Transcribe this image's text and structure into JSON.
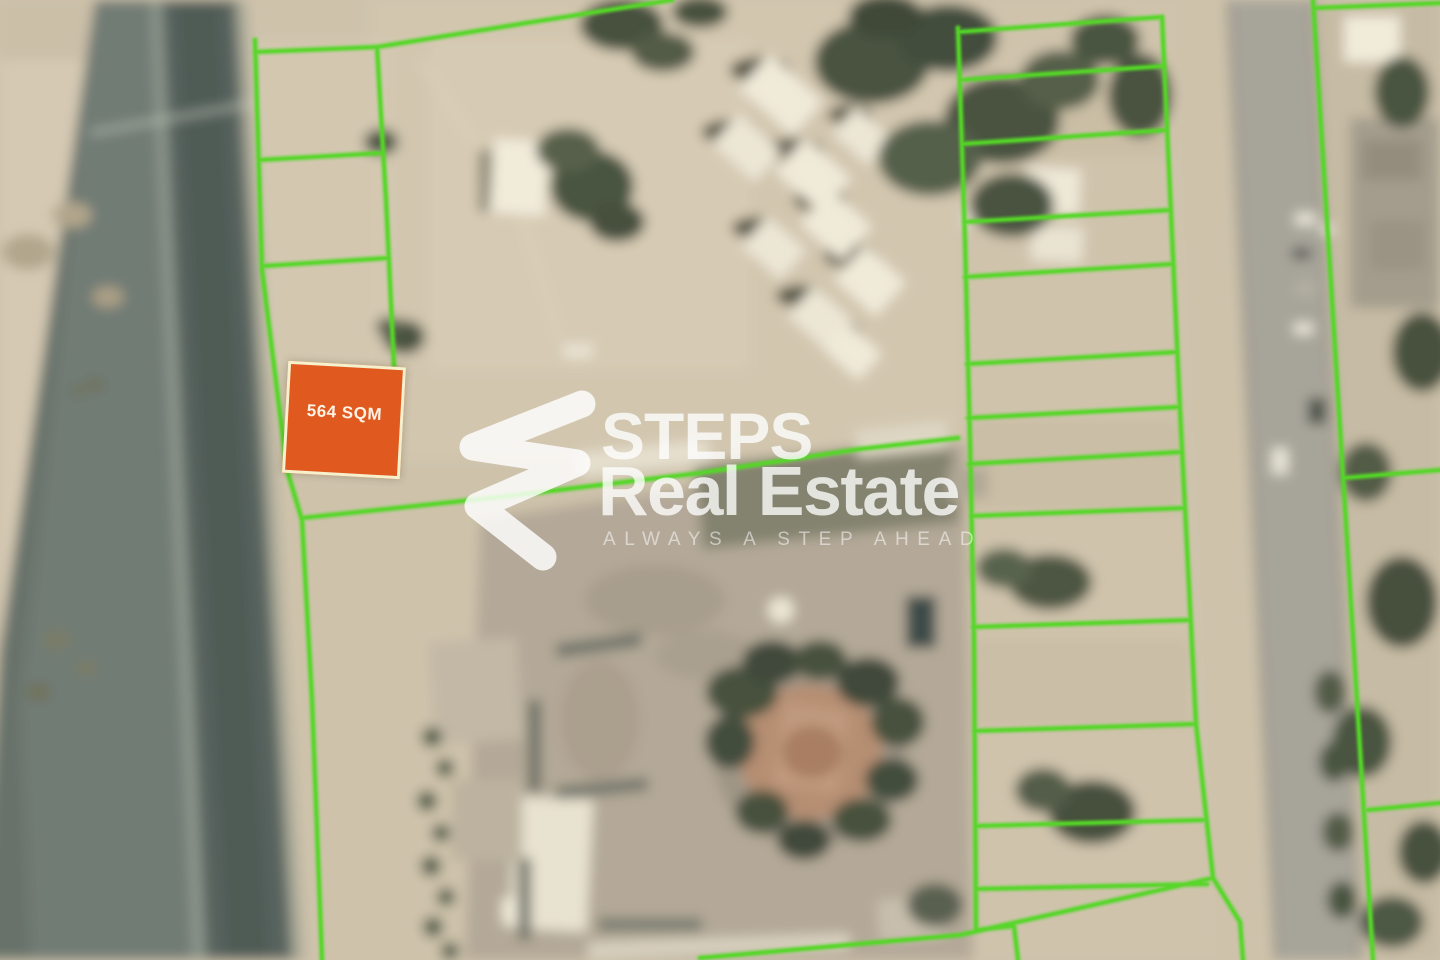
{
  "plot": {
    "area_label": "564 SQM",
    "fill_color": "#e05a20",
    "border_color": "#f6f0cc",
    "label_color": "#fff3e6"
  },
  "boundaries": {
    "line_color": "#55d726"
  },
  "watermark": {
    "logo_icon": "steps-logo-icon",
    "brand_line1": "STEPS",
    "brand_line2": "Real Estate",
    "tagline": "ALWAYS A STEP AHEAD",
    "text_color": "#ffffff"
  }
}
